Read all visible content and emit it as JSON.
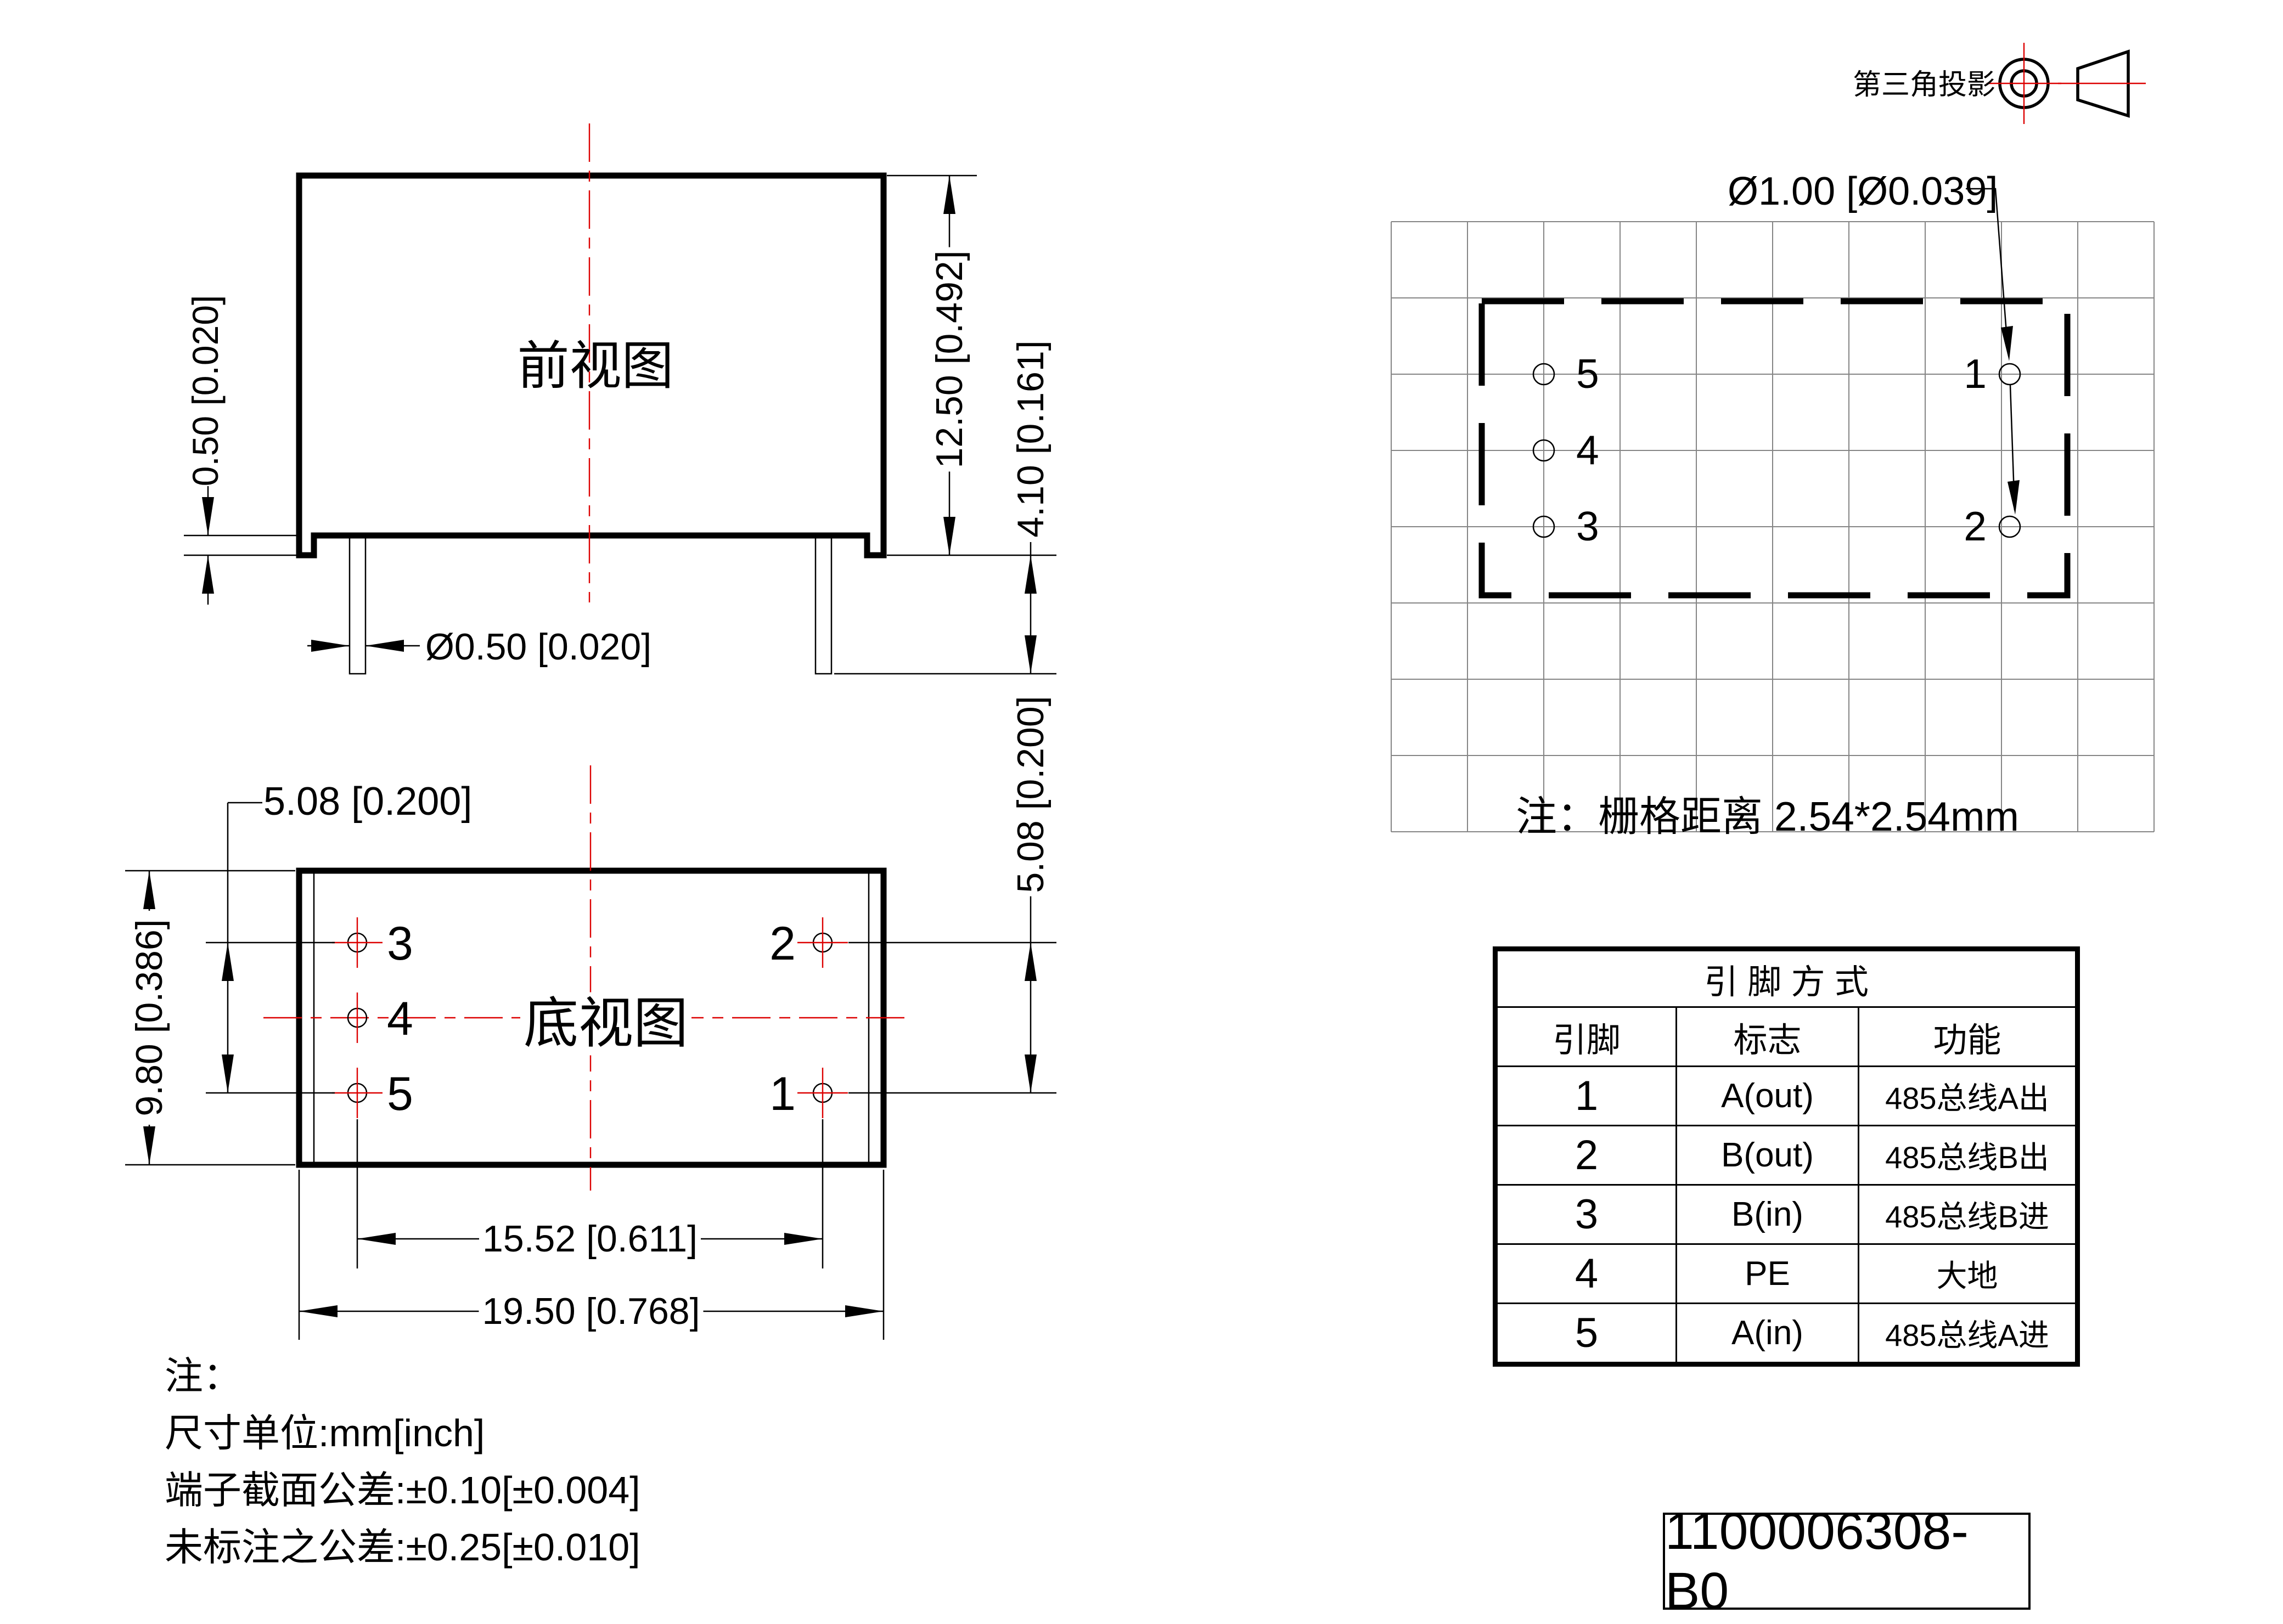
{
  "projection": {
    "label": "第三角投影"
  },
  "front_view": {
    "title": "前视图",
    "dim_height": "12.50 [0.492]",
    "dim_pin_length": "4.10 [0.161]",
    "dim_standoff": "0.50 [0.020]",
    "dim_pin_diameter": "Ø0.50 [0.020]"
  },
  "bottom_view": {
    "title": "底视图",
    "dim_pin_row_pitch_left": "5.08 [0.200]",
    "dim_pin_row_pitch_right": "5.08 [0.200]",
    "dim_body_depth": "9.80 [0.386]",
    "dim_pin_column_span": "15.52 [0.611]",
    "dim_body_width": "19.50 [0.768]",
    "pin_labels": [
      "3",
      "4",
      "5",
      "2",
      "1"
    ]
  },
  "footprint": {
    "dim_hole_diameter": "Ø1.00 [Ø0.039]",
    "grid_note": "注：栅格距离 2.54*2.54mm",
    "pin_labels": [
      "5",
      "4",
      "3",
      "1",
      "2"
    ]
  },
  "pin_table": {
    "title": "引 脚 方 式",
    "headers": [
      "引脚",
      "标志",
      "功能"
    ],
    "rows": [
      [
        "1",
        "A(out)",
        "485总线A出"
      ],
      [
        "2",
        "B(out)",
        "485总线B出"
      ],
      [
        "3",
        "B(in)",
        "485总线B进"
      ],
      [
        "4",
        "PE",
        "大地"
      ],
      [
        "5",
        "A(in)",
        "485总线A进"
      ]
    ]
  },
  "notes": {
    "title": "注：",
    "lines": [
      "尺寸单位:mm[inch]",
      "端子截面公差:±0.10[±0.004]",
      "未标注之公差:±0.25[±0.010]"
    ]
  },
  "part_number": "1100006308-B0",
  "colors": {
    "ink": "#000000",
    "centerline_red": "#dd0000",
    "grid_gray": "#858585",
    "paper": "#ffffff"
  }
}
